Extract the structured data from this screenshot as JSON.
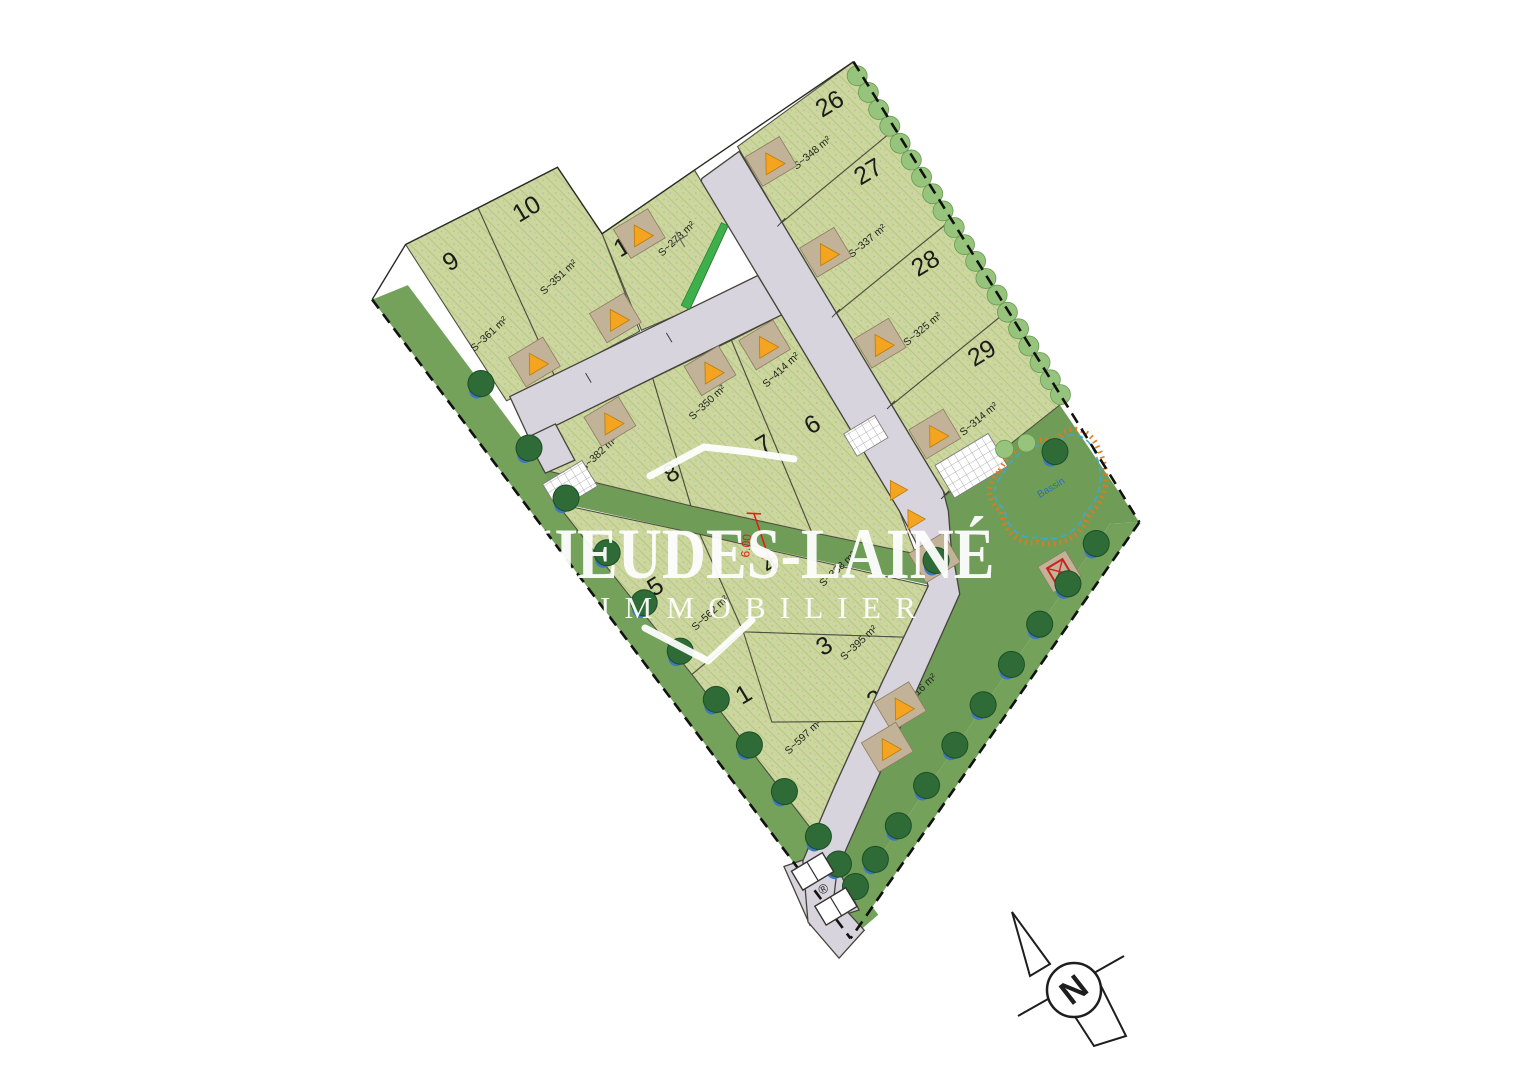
{
  "watermark": {
    "line1": "HEUDES-LAINÉ",
    "line2": "IMMOBILIER"
  },
  "north": {
    "label": "N"
  },
  "annotations": {
    "red_dimension": "6.00",
    "basin_label": "Bassin",
    "r_symbol": "®"
  },
  "parcels": [
    {
      "number": "9",
      "surface": "S~361 m²"
    },
    {
      "number": "10",
      "surface": "S~351 m²"
    },
    {
      "number": "11",
      "surface": "S~273 m²"
    },
    {
      "number": "26",
      "surface": "S~348 m²"
    },
    {
      "number": "27",
      "surface": "S~337 m²"
    },
    {
      "number": "28",
      "surface": "S~325 m²"
    },
    {
      "number": "29",
      "surface": "S~314 m²"
    },
    {
      "number": "8",
      "surface": "S~382 m²"
    },
    {
      "number": "7",
      "surface": "S~350 m²"
    },
    {
      "number": "6",
      "surface": "S~414 m²"
    },
    {
      "number": "5",
      "surface": "S~562 m²"
    },
    {
      "number": "4",
      "surface": "S~338 m²"
    },
    {
      "number": "3",
      "surface": "S~395 m²"
    },
    {
      "number": "2",
      "surface": "S~416 m²"
    },
    {
      "number": "1",
      "surface": "S~597 m²"
    }
  ],
  "colors": {
    "parcel_fill": "#cbd79d",
    "road_fill": "#d8d4de",
    "green_space": "#6f9d58",
    "hedge": "#96c47d",
    "garage_pad": "#c2b298",
    "marker_triangle": "#f4a41f",
    "boundary": "#121210",
    "basin_outline": "#3fa8d0",
    "basin_hachure": "#e07a20",
    "dimension_red": "#dd2212",
    "watermark": "#ffffff"
  }
}
